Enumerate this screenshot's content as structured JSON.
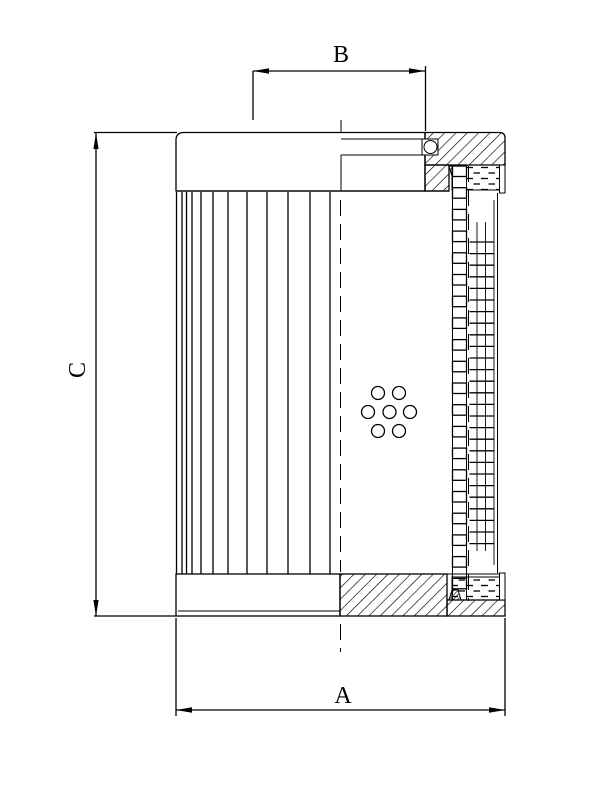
{
  "drawing": {
    "dimension_labels": {
      "a": "A",
      "b": "B",
      "c": "C"
    },
    "colors": {
      "line": "#000000",
      "background": "#ffffff"
    }
  }
}
